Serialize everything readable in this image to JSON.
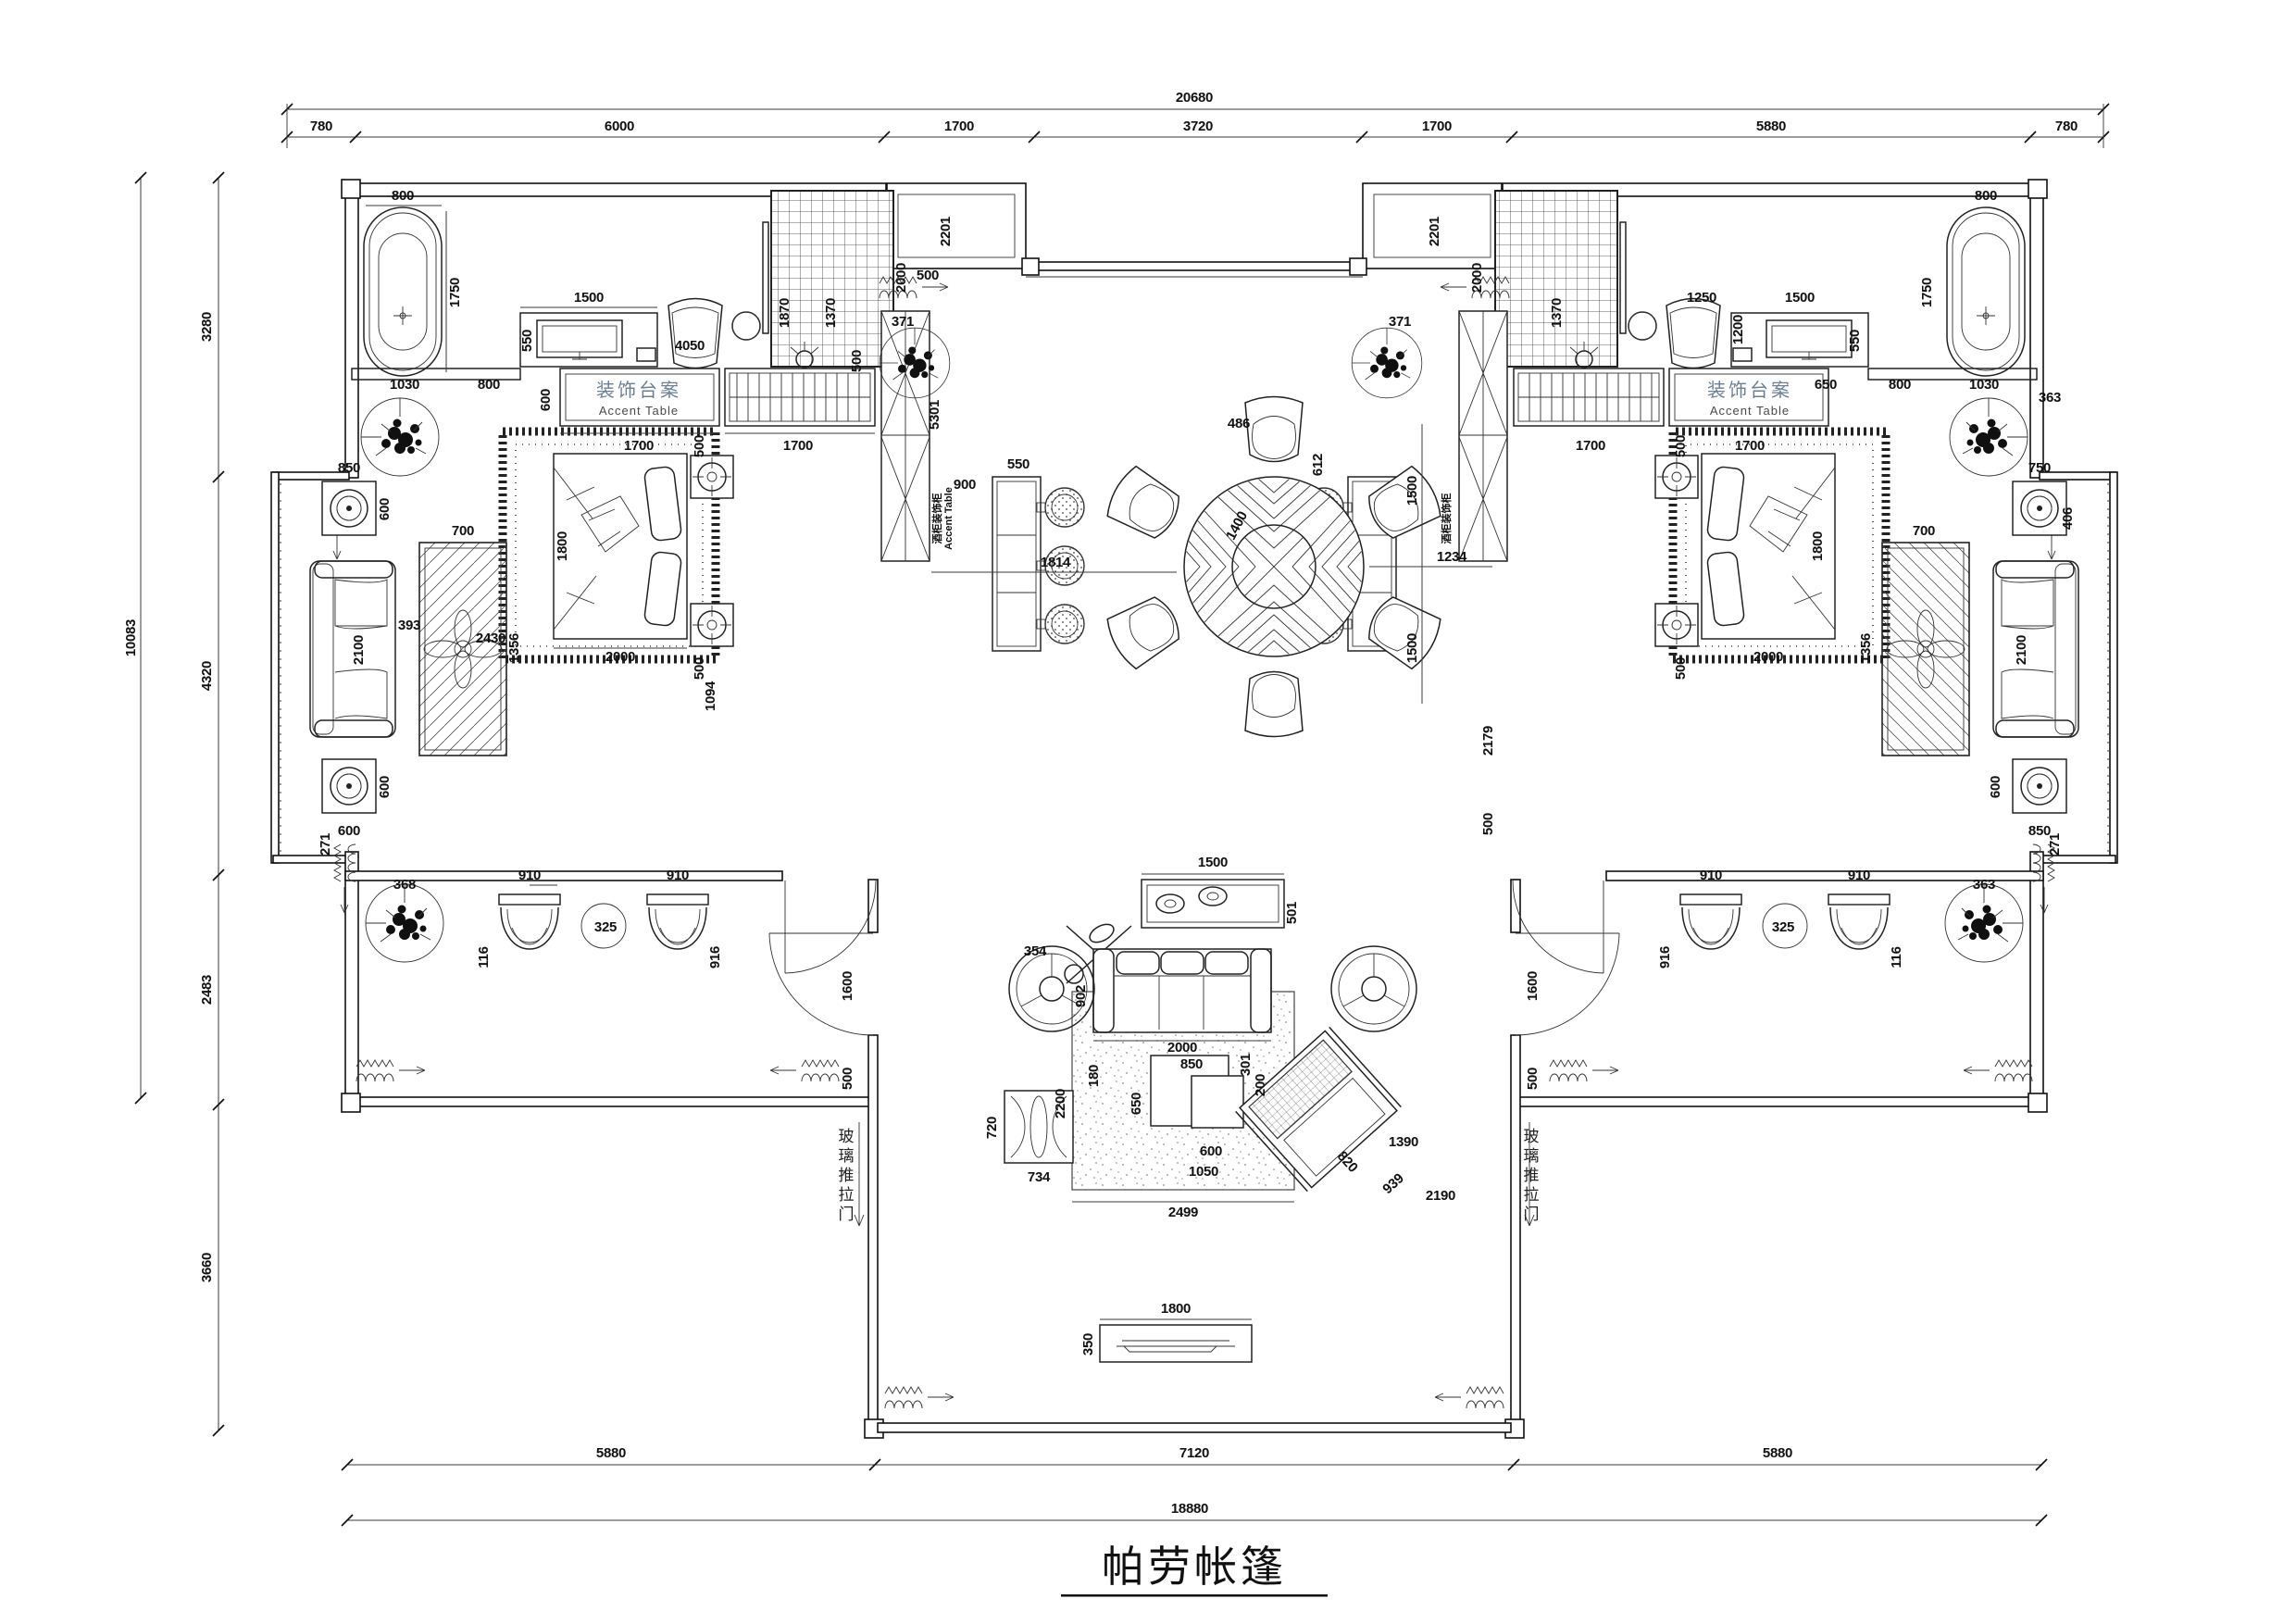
{
  "title": "帕劳帐篷",
  "labels": {
    "accent_table_cn": "装饰台案",
    "accent_table_en": "Accent Table",
    "wine_cabinet_cn": "酒柜装饰柜",
    "wine_cabinet_en": "Accent Table",
    "glass_sliding_door": "玻璃推拉门"
  },
  "dim_chains": {
    "top_total": "20680",
    "top": [
      "780",
      "6000",
      "1700",
      "3720",
      "1700",
      "5880",
      "780"
    ],
    "left_total": "10083",
    "left": [
      "3280",
      "4320",
      "2483",
      "3660"
    ],
    "bottom": [
      "5880",
      "7120",
      "5880"
    ],
    "bottom_total": "18880"
  },
  "dims": {
    "tub_w": "800",
    "tub_l": "1750",
    "tub_off": "1030",
    "tub_gap": "800",
    "desk_w": "1500",
    "desk_d": "550",
    "chair_code": "4050",
    "counter_d": "600",
    "accent_w": "1700",
    "rack_w": "1700",
    "shower_h": "2000",
    "screen_h": "5301",
    "entry_h": "2201",
    "entry_off": "500",
    "bar_gap": "900",
    "bar_w": "550",
    "chair_w": "486",
    "chair_d": "612",
    "table_d": "1400",
    "dine_left": "1814",
    "dine_right": "1234",
    "dine_up": "1500",
    "dine_down": "1500",
    "bed_l": "1800",
    "bed_w": "2000",
    "nightstand": "500",
    "bed_off": "1094",
    "ward_a": "1870",
    "ward_b": "1370",
    "ward_c": "500",
    "to_sofa": "2430",
    "ct_w": "700",
    "ct_l": "1356",
    "sofa_l": "2100",
    "side_t": "600",
    "side_t_w": "850",
    "sofa_gap": "393",
    "plant_t": "368",
    "deck_chair": "910",
    "deck_gap": "325",
    "deck_d1": "116",
    "deck_d2": "916",
    "door_w": "1600",
    "door_off": "500",
    "console_w": "1500",
    "console_d": "501",
    "lamp_r": "354",
    "sofa_d": "902",
    "sofa_w": "2000",
    "rug_l": "2200",
    "rug_w": "2499",
    "rug_r": "2190",
    "tbl_a": "850",
    "tbl_b": "650",
    "tbl_c": "600",
    "tbl_d": "1050",
    "tbl_e": "301",
    "tbl_f": "180",
    "tbl_g": "200",
    "lounge_w": "820",
    "lounge_d": "939",
    "lounge_off": "1390",
    "bench_w": "734",
    "bench_d": "720",
    "tv_w": "1800",
    "tv_d": "350",
    "plant_a": "371",
    "plant_b": "363",
    "shelf_r": "650",
    "right_a": "1250",
    "right_b": "1200",
    "right_c": "2179",
    "right_d": "500",
    "bay_a": "750",
    "bay_b": "406",
    "bay_c": "271"
  }
}
